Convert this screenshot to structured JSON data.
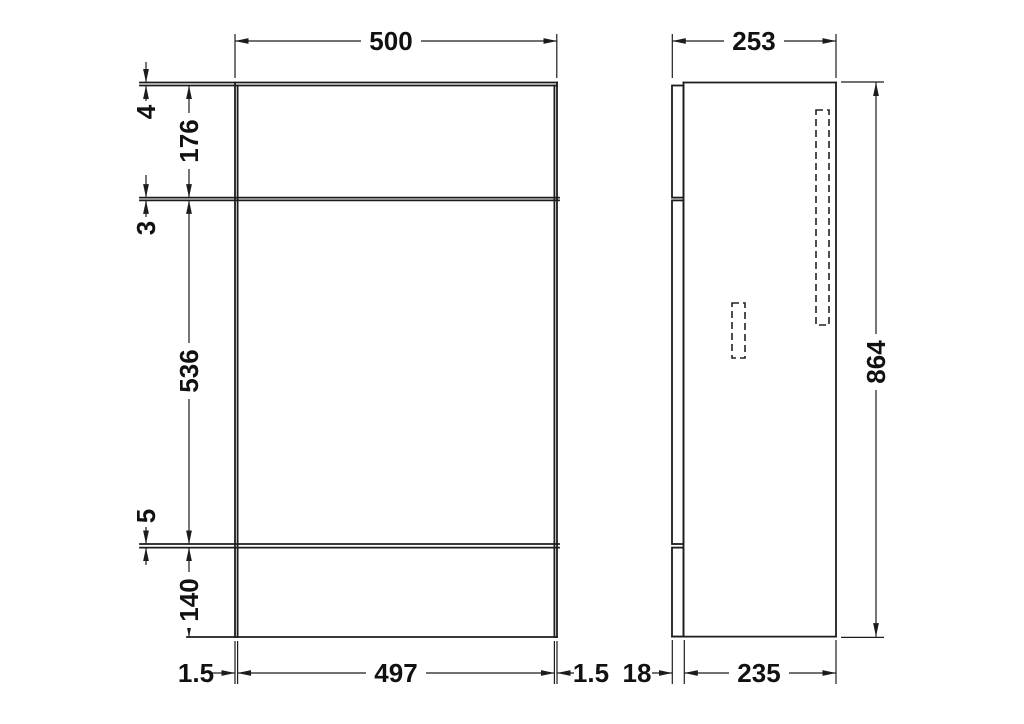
{
  "colors": {
    "background": "#ffffff",
    "line": "#1c1c1c",
    "text": "#111111"
  },
  "front_view": {
    "width_label": "500",
    "rim_thickness": "4",
    "top_panel_height": "176",
    "top_gap": "3",
    "door_height": "536",
    "bottom_gap": "5",
    "plinth_height": "140",
    "left_edge_inset": "1.5",
    "panel_width": "497",
    "right_edge_inset": "1.5"
  },
  "side_view": {
    "depth_label": "253",
    "height_label": "864",
    "door_thickness": "18",
    "body_depth": "235"
  }
}
